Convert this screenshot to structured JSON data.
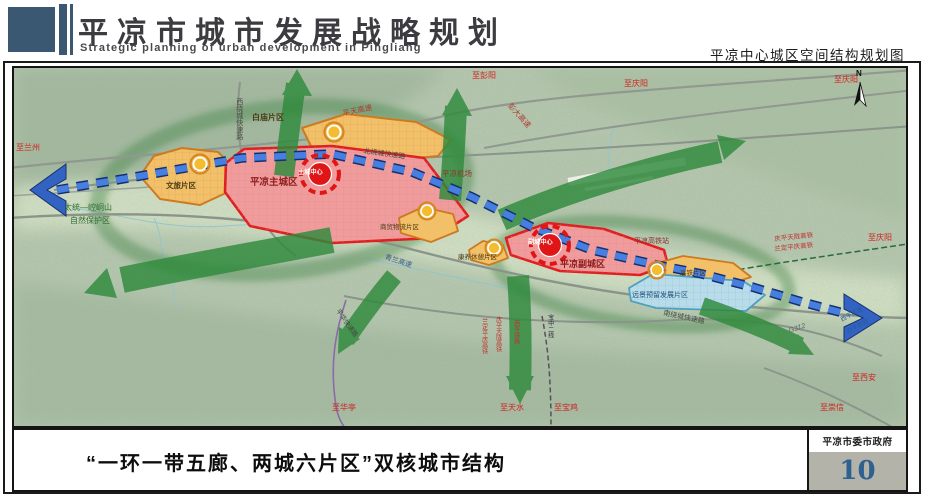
{
  "header": {
    "title_cn": "平凉市城市发展战略规划",
    "title_en": "Strategic planning of urban development in Pingliang",
    "map_title": "平凉中心城区空间结构规划图"
  },
  "footer": {
    "caption": "“一环一带五廊、两城六片区”双核城市结构",
    "agency": "平凉市委市政府",
    "page_number": "10"
  },
  "map": {
    "colors": {
      "corridor_green": "#2f8a3c",
      "axis_blue": "#3263c2",
      "main_city_fill": "#f09c9c",
      "main_city_border": "#e02020",
      "district_fill": "#f3c06a",
      "district_border": "#cc7a1f",
      "reserved_fill": "#b9dcea",
      "center_marker_red": "#e01515",
      "node_gold": "#f3bd2e"
    },
    "labels": [
      {
        "name": "to-lanzhou",
        "text": "至兰州",
        "x": 2,
        "y": 76,
        "size": 8,
        "color": "#d42020"
      },
      {
        "name": "west-ring-road",
        "text": "西绕城快速路",
        "x": 221,
        "y": 30,
        "size": 7,
        "color": "#4a4a42",
        "vertical": true
      },
      {
        "name": "pingtian-expressway",
        "text": "平天高速",
        "x": 328,
        "y": 42,
        "size": 7.5,
        "color": "#b03a2e",
        "rotate": -12
      },
      {
        "name": "pengda-expressway",
        "text": "彭大高速",
        "x": 498,
        "y": 34,
        "size": 7.5,
        "color": "#b03a2e",
        "rotate": 48
      },
      {
        "name": "to-pengyang",
        "text": "至彭阳",
        "x": 458,
        "y": 4,
        "size": 8,
        "color": "#d42020"
      },
      {
        "name": "to-qingyang-top",
        "text": "至庆阳",
        "x": 610,
        "y": 12,
        "size": 8,
        "color": "#d42020"
      },
      {
        "name": "to-qingyang-topright",
        "text": "至庆阳",
        "x": 820,
        "y": 8,
        "size": 8,
        "color": "#d42020"
      },
      {
        "name": "north-ring-road",
        "text": "北绕城快速路",
        "x": 350,
        "y": 80,
        "size": 7,
        "color": "#41493f",
        "rotate": 8
      },
      {
        "name": "baimiao-district",
        "text": "白庙片区",
        "x": 238,
        "y": 46,
        "size": 8,
        "color": "#4a3a14",
        "bold": true
      },
      {
        "name": "pingliang-airport",
        "text": "平凉机场",
        "x": 428,
        "y": 102,
        "size": 7.5,
        "color": "#8b3a2a"
      },
      {
        "name": "main-city",
        "text": "平凉主城区",
        "x": 236,
        "y": 110,
        "size": 9.5,
        "color": "#8d1b1b",
        "bold": true
      },
      {
        "name": "main-center",
        "text": "主城中心",
        "x": 284,
        "y": 102,
        "size": 6.2,
        "color": "#ffffff",
        "bold": true
      },
      {
        "name": "wenlv-district",
        "text": "文旅片区",
        "x": 152,
        "y": 114,
        "size": 7.5,
        "color": "#4a3a14",
        "bold": true
      },
      {
        "name": "nature-reserve-line1",
        "text": "太统—崆峒山",
        "x": 50,
        "y": 136,
        "size": 8,
        "color": "#2f6b33"
      },
      {
        "name": "nature-reserve-line2",
        "text": "自然保护区",
        "x": 56,
        "y": 149,
        "size": 8,
        "color": "#2f6b33"
      },
      {
        "name": "qinglan-expressway",
        "text": "青兰高速",
        "x": 372,
        "y": 186,
        "size": 7,
        "color": "#3a5a8a",
        "rotate": 18
      },
      {
        "name": "shangmao-district",
        "text": "商贸物流片区",
        "x": 366,
        "y": 156,
        "size": 6.5,
        "color": "#4a3a14"
      },
      {
        "name": "kangyang-district",
        "text": "康养休憩片区",
        "x": 444,
        "y": 186,
        "size": 6.5,
        "color": "#4a3a14"
      },
      {
        "name": "sub-center",
        "text": "副城中心",
        "x": 514,
        "y": 172,
        "size": 6.2,
        "color": "#ffffff",
        "bold": true
      },
      {
        "name": "sub-city",
        "text": "平凉副城区",
        "x": 546,
        "y": 192,
        "size": 9,
        "color": "#8d1b1b",
        "bold": true
      },
      {
        "name": "hsr-station",
        "text": "平凉高铁站",
        "x": 620,
        "y": 170,
        "size": 7,
        "color": "#8b2a2a"
      },
      {
        "name": "gaotie-district",
        "text": "高铁片区",
        "x": 666,
        "y": 202,
        "size": 6.5,
        "color": "#4a3a14"
      },
      {
        "name": "reserved-district",
        "text": "远景预留发展片区",
        "x": 618,
        "y": 224,
        "size": 7,
        "color": "#1f4e79"
      },
      {
        "name": "south-ring-road",
        "text": "南绕城快速路",
        "x": 650,
        "y": 242,
        "size": 7,
        "color": "#41493f",
        "rotate": 12
      },
      {
        "name": "qingping-tianlong-hsr",
        "text": "庆平天陇高铁",
        "x": 760,
        "y": 168,
        "size": 6.5,
        "color": "#c03030",
        "rotate": -6
      },
      {
        "name": "landing-pingqing-hsr",
        "text": "兰定平庆高铁",
        "x": 760,
        "y": 178,
        "size": 6.5,
        "color": "#c03030",
        "rotate": -6
      },
      {
        "name": "to-qingyang-right",
        "text": "至庆阳",
        "x": 854,
        "y": 166,
        "size": 8,
        "color": "#d42020"
      },
      {
        "name": "g312-road",
        "text": "G312",
        "x": 774,
        "y": 260,
        "size": 7,
        "color": "#55606a",
        "rotate": -18,
        "italic": true
      },
      {
        "name": "xiping-expressway",
        "text": "西平高速",
        "x": 826,
        "y": 250,
        "size": 6,
        "color": "#2a5a9a",
        "rotate": -28
      },
      {
        "name": "xiping-railway",
        "text": "西平铁路",
        "x": 832,
        "y": 262,
        "size": 6,
        "color": "#2a5a9a",
        "rotate": -28
      },
      {
        "name": "to-xian",
        "text": "至西安",
        "x": 838,
        "y": 306,
        "size": 8,
        "color": "#d42020"
      },
      {
        "name": "to-chongxin",
        "text": "至崇信",
        "x": 806,
        "y": 336,
        "size": 8,
        "color": "#d42020"
      },
      {
        "name": "to-huating",
        "text": "至华亭",
        "x": 318,
        "y": 336,
        "size": 8,
        "color": "#d42020"
      },
      {
        "name": "to-tianshui",
        "text": "至天水",
        "x": 486,
        "y": 336,
        "size": 8,
        "color": "#d42020"
      },
      {
        "name": "to-baoji",
        "text": "至宝鸡",
        "x": 540,
        "y": 336,
        "size": 8,
        "color": "#d42020"
      },
      {
        "name": "landing-pingqing-hsr-vertical",
        "text": "兰定平庆高铁",
        "x": 466,
        "y": 250,
        "size": 6,
        "color": "#c03030",
        "vertical": true
      },
      {
        "name": "qingping-tianlong-hsr-vertical",
        "text": "庆平天陇高铁",
        "x": 480,
        "y": 248,
        "size": 6,
        "color": "#c03030",
        "vertical": true
      },
      {
        "name": "xiping-railway-vertical",
        "text": "西平铁路",
        "x": 498,
        "y": 252,
        "size": 6,
        "color": "#c03030",
        "vertical": true
      },
      {
        "name": "baozhong-line-2",
        "text": "宝中二线",
        "x": 532,
        "y": 246,
        "size": 6,
        "color": "#2a2a3a",
        "vertical": true
      },
      {
        "name": "pinghua-road",
        "text": "平华快速路",
        "x": 326,
        "y": 240,
        "size": 6.5,
        "color": "#41493f",
        "rotate": 55
      },
      {
        "name": "compass-n",
        "text": "N",
        "x": 842,
        "y": 2,
        "size": 8,
        "color": "#111111",
        "bold": true
      }
    ]
  }
}
